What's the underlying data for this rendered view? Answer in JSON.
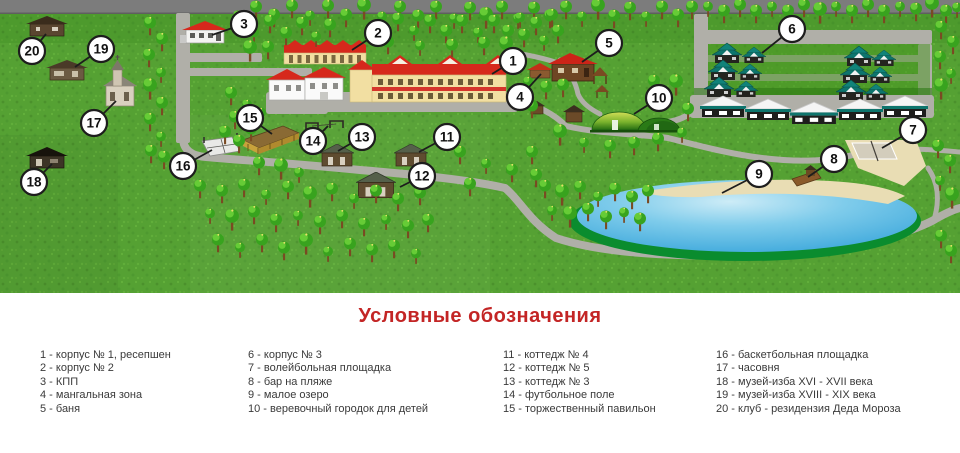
{
  "map": {
    "markers": [
      "1",
      "2",
      "3",
      "4",
      "5",
      "6",
      "7",
      "8",
      "9",
      "10",
      "11",
      "12",
      "13",
      "14",
      "15",
      "16",
      "17",
      "18",
      "19",
      "20"
    ]
  },
  "legend": {
    "title": "Условные обозначения",
    "columns": [
      {
        "items": [
          "1 - корпус № 1, ресепшен",
          "2 - корпус № 2",
          "3 - КПП",
          "4 - мангальная зона",
          "5 - баня"
        ]
      },
      {
        "items": [
          "6 - корпус № 3",
          "7 - волейбольная площадка",
          "8 - бар на пляже",
          "9 - малое озеро",
          "10 - веревочный городок для детей"
        ]
      },
      {
        "items": [
          "11 - коттедж № 4",
          "12 - коттедж № 5",
          "13 - коттедж № 3",
          "14 - футбольное поле",
          "15 - торжественный павильон"
        ]
      },
      {
        "items": [
          "16 - баскетбольная площадка",
          "17 - часовня",
          "18 - музей-изба XVI - XVII века",
          "19 - музей-изба XVIII - XIX века",
          "20 - клуб - резидензия Деда Мороза"
        ]
      }
    ]
  },
  "colors": {
    "legend_title": "#c32525",
    "grass": "#55a133",
    "tree": "#38a31e",
    "road": "#b0afa8",
    "top_road": "#7c7c7c",
    "lake": "#54b7e3",
    "lake_shore": "#0a8c2e",
    "sand": "#e9ddb4",
    "roof_red": "#d6281c",
    "building_yellow": "#f2dfa2",
    "cottage_teal": "#0e756d"
  }
}
